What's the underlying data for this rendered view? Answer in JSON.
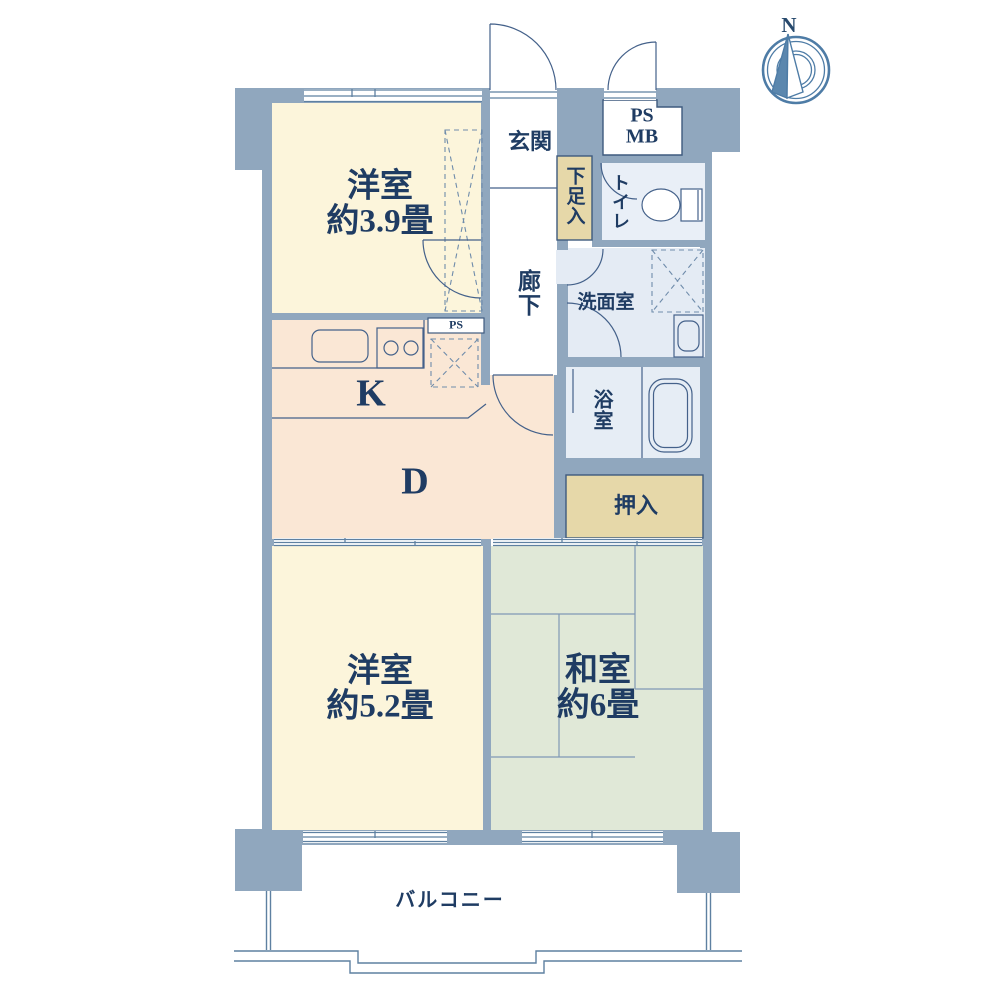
{
  "compass": {
    "label": "N"
  },
  "rooms": {
    "western_upper": {
      "name": "洋室",
      "size": "約3.9畳"
    },
    "entrance": {
      "label": "玄関"
    },
    "ps_mb": {
      "line1": "PS",
      "line2": "MB"
    },
    "shoe_cabinet": {
      "label": "下足入"
    },
    "toilet": {
      "label": "トイレ"
    },
    "hallway": {
      "label": "廊下"
    },
    "washroom": {
      "label": "洗面室"
    },
    "kitchen": {
      "label": "K"
    },
    "dining": {
      "label": "D"
    },
    "ps_small": {
      "label": "PS"
    },
    "bathroom": {
      "label": "浴室"
    },
    "closet": {
      "label": "押入"
    },
    "western_lower": {
      "name": "洋室",
      "size": "約5.2畳"
    },
    "japanese_room": {
      "name": "和室",
      "size": "約6畳"
    },
    "balcony": {
      "label": "バルコニー"
    }
  },
  "colors": {
    "wall": "#90A7BE",
    "cream_room": "#FCF5DB",
    "peach_room": "#FAE7D5",
    "green_room": "#E0E8D7",
    "tan_storage": "#E6D8A9",
    "wet_room_blue": "#E6EDF5",
    "line": "#5E80A1",
    "outline_dark": "#3E5A7E",
    "text_navy": "#1F3C63",
    "compass_blue": "#4E7CA6"
  }
}
